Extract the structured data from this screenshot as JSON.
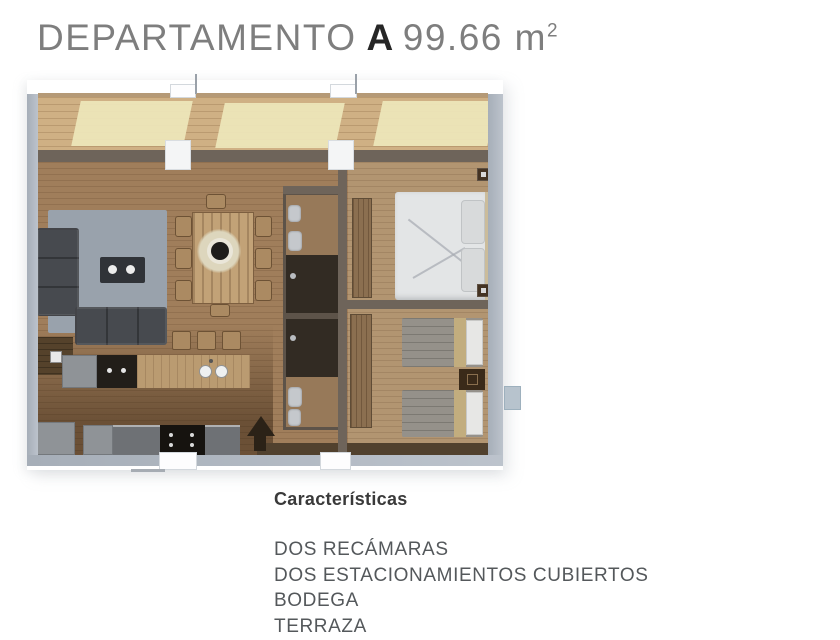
{
  "header": {
    "building": "DEPARTAMENTO",
    "unit": "A",
    "area": "99.66 m",
    "area_sup": "2"
  },
  "floorplan": {
    "description": "Top-down 3D rendering of apartment unit A",
    "rooms": [
      "terraza",
      "sala",
      "comedor",
      "cocina",
      "baño 1",
      "baño 2",
      "recámara principal",
      "recámara 2"
    ],
    "palette": {
      "terrace_wood": "#cfb084",
      "sunlight": "#eee7bb",
      "interior_wood": "#a07e5b",
      "bedroom_wood": "#b29571",
      "kitchen_dark_wood": "#5e4326",
      "wall_outer": "#b2bac4",
      "wall_inner": "#6e645a",
      "rug": "#99a2ac",
      "sofa": "#474a4f",
      "master_bed": "#e3e5e6",
      "twin_bed": "#95918a",
      "entry_arrow": "#2b2217"
    }
  },
  "features": {
    "heading": "Características",
    "items": [
      "DOS RECÁMARAS",
      "DOS ESTACIONAMIENTOS CUBIERTOS",
      "BODEGA",
      "TERRAZA"
    ]
  },
  "colors": {
    "title_light": "#7e7e7e",
    "title_accent": "#262626",
    "body_text": "#54585b",
    "background": "#ffffff"
  }
}
